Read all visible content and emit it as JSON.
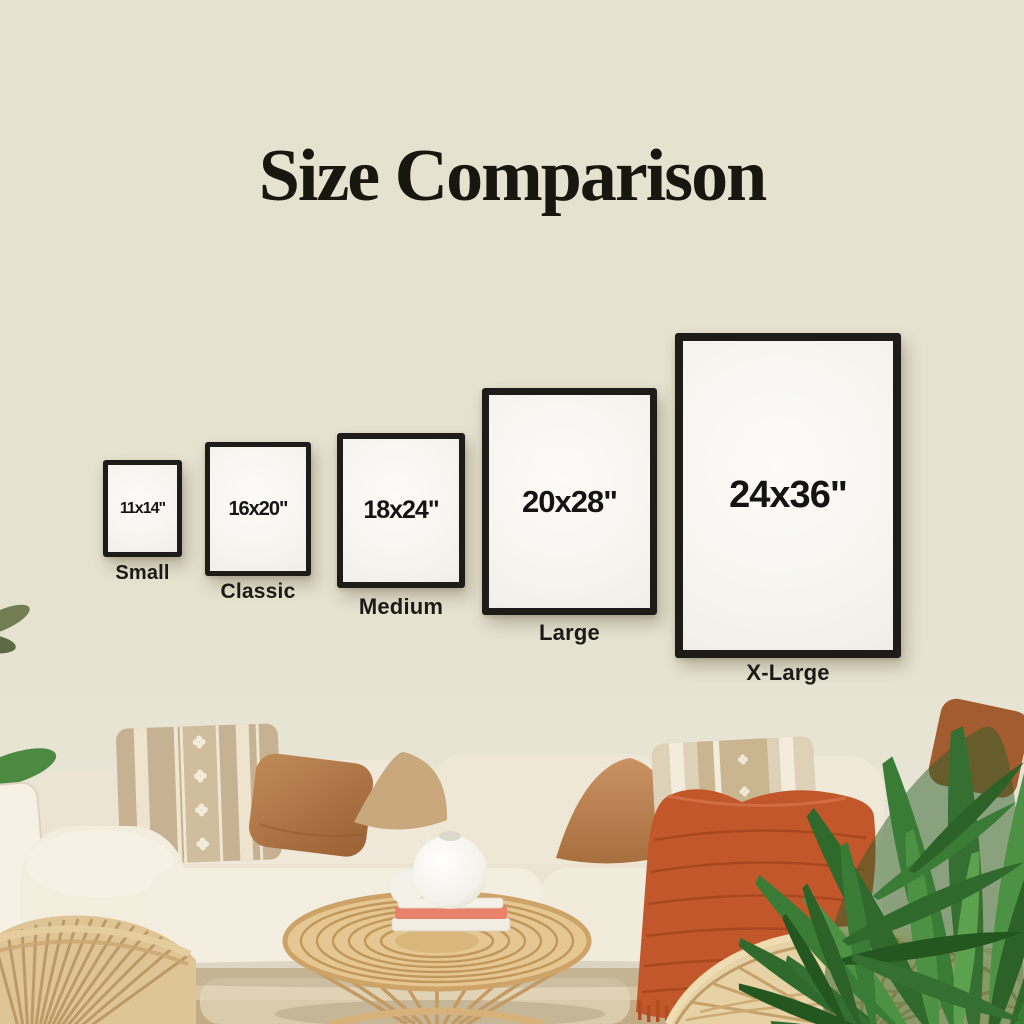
{
  "title": "Size Comparison",
  "frames": [
    {
      "id": "small",
      "size": "11x14\"",
      "label": "Small"
    },
    {
      "id": "classic",
      "size": "16x20\"",
      "label": "Classic"
    },
    {
      "id": "medium",
      "size": "18x24\"",
      "label": "Medium"
    },
    {
      "id": "large",
      "size": "20x28\"",
      "label": "Large"
    },
    {
      "id": "xlarge",
      "size": "24x36\"",
      "label": "X-Large"
    }
  ],
  "palette": {
    "background": "#e6e2d0",
    "frame_border": "#1d1c18",
    "frame_matte": "#f8f7f2",
    "text": "#17160f",
    "sofa_ivory": "#f0e9da",
    "pillow_tan": "#c6b292",
    "pillow_rust": "#a96f42",
    "throw_orange": "#c2572b",
    "rattan": "#d9b87f",
    "plant_green": "#3a7c36"
  }
}
